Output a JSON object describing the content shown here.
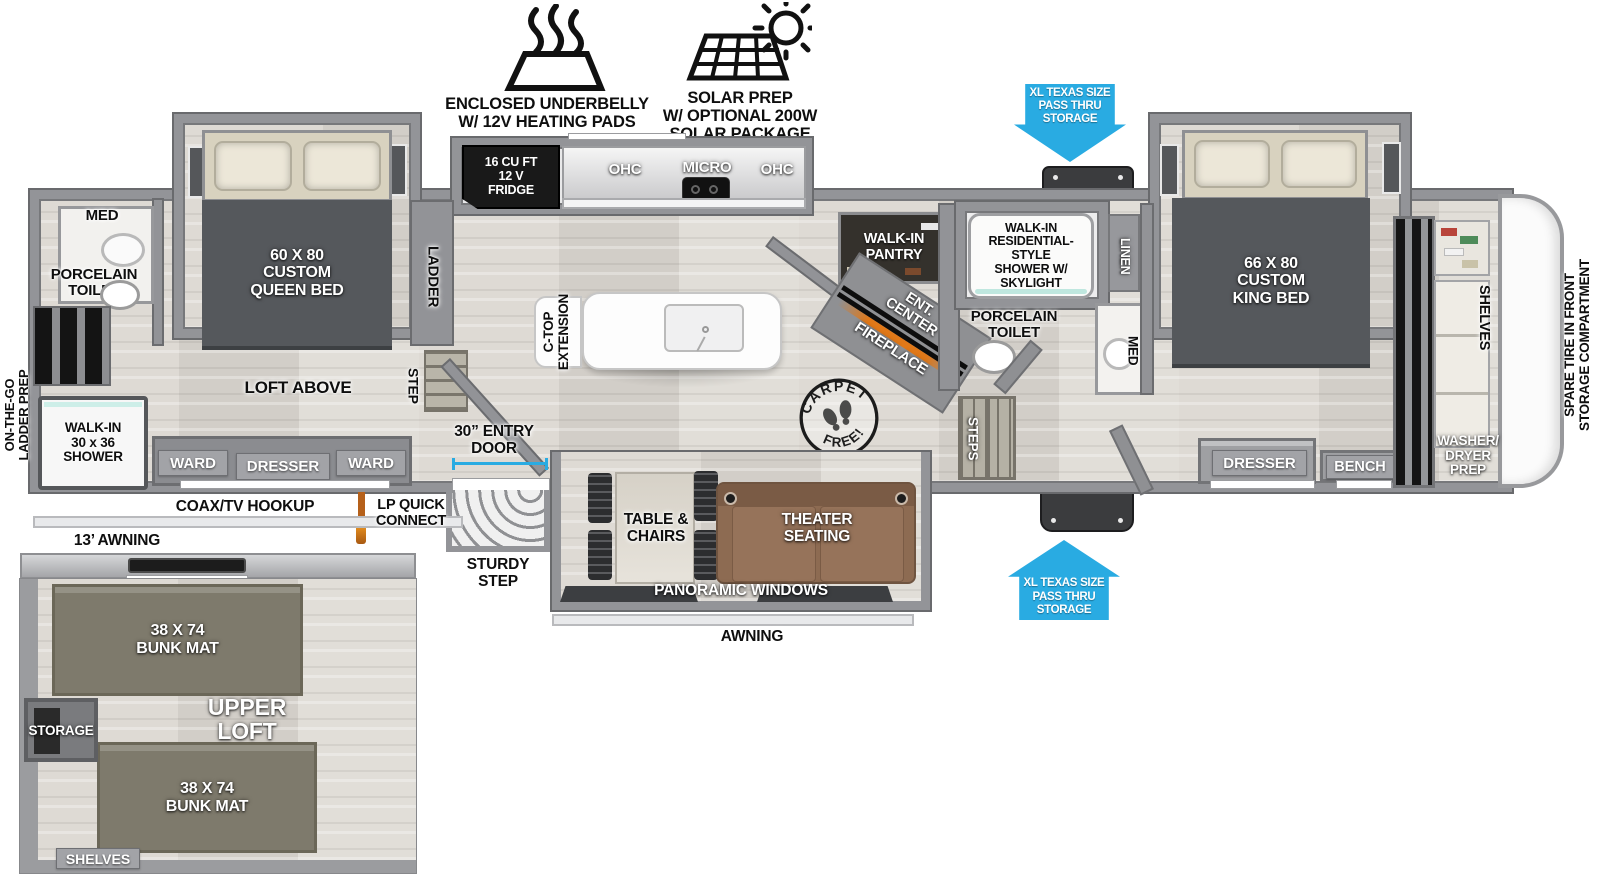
{
  "colors": {
    "accent_blue": "#29abe2",
    "wall_gray": "#929397",
    "furniture_dark": "#55585c",
    "sofa_brown": "#8d6b52",
    "bunk_olive": "#7e7a6c",
    "fireplace_orange": "#e07818"
  },
  "features": {
    "underbelly": "ENCLOSED UNDERBELLY\nW/ 12V HEATING PADS",
    "solar": "SOLAR PREP\nW/ OPTIONAL 200W\nSOLAR PACKAGE"
  },
  "pass_thru": {
    "top": "XL TEXAS SIZE\nPASS THRU\nSTORAGE",
    "bottom": "XL TEXAS SIZE\nPASS THRU\nSTORAGE"
  },
  "rear_bath": {
    "med": "MED",
    "toilet": "PORCELAIN\nTOILET",
    "shower": "WALK-IN\n30 x 36\nSHOWER",
    "ladder_prep": "ON-THE-GO\nLADDER PREP"
  },
  "rear_bedroom": {
    "bed": "60 X  80\nCUSTOM\nQUEEN BED",
    "loft": "LOFT ABOVE",
    "ward_left": "WARD",
    "dresser": "DRESSER",
    "ward_right": "WARD",
    "ladder": "LADDER",
    "step": "STEP"
  },
  "kitchen": {
    "fridge": "16 CU FT\n12 V\nFRIDGE",
    "ohc_left": "OHC",
    "micro": "MICRO",
    "ohc_right": "OHC",
    "ctop": "C-TOP\nEXTENSION",
    "pantry": "WALK-IN\nPANTRY",
    "ent_center": "ENT.\nCENTER",
    "fireplace": "FIREPLACE"
  },
  "entry": {
    "door": "30” ENTRY\nDOOR",
    "step": "STURDY\nSTEP"
  },
  "living": {
    "table": "TABLE &\nCHAIRS",
    "theater": "THEATER\nSEATING",
    "windows": "PANORAMIC WINDOWS",
    "awning": "AWNING",
    "carpet_arc_top": "CARPET",
    "carpet_arc_bottom": "FREE!"
  },
  "utilities": {
    "coax": "COAX/TV HOOKUP",
    "lp": "LP QUICK\nCONNECT",
    "awning_13": "13’ AWNING"
  },
  "mid_bath": {
    "shower": "WALK-IN\nRESIDENTIAL-STYLE\nSHOWER W/\nSKYLIGHT",
    "linen": "LINEN",
    "toilet": "PORCELAIN\nTOILET",
    "med": "MED",
    "steps": "STEPS"
  },
  "front_bedroom": {
    "bed": "66 X  80\nCUSTOM\nKING BED",
    "dresser": "DRESSER",
    "bench": "BENCH",
    "shelves": "SHELVES",
    "washer": "WASHER/\nDRYER\nPREP"
  },
  "front_cap": {
    "spare_tire": "SPARE TIRE IN FRONT\nSTORAGE COMPARTMENT"
  },
  "loft": {
    "title": "UPPER\nLOFT",
    "bunk_top": "38 X 74\nBUNK MAT",
    "bunk_bottom": "38 X 74\nBUNK MAT",
    "storage": "STORAGE",
    "shelves": "SHELVES"
  }
}
